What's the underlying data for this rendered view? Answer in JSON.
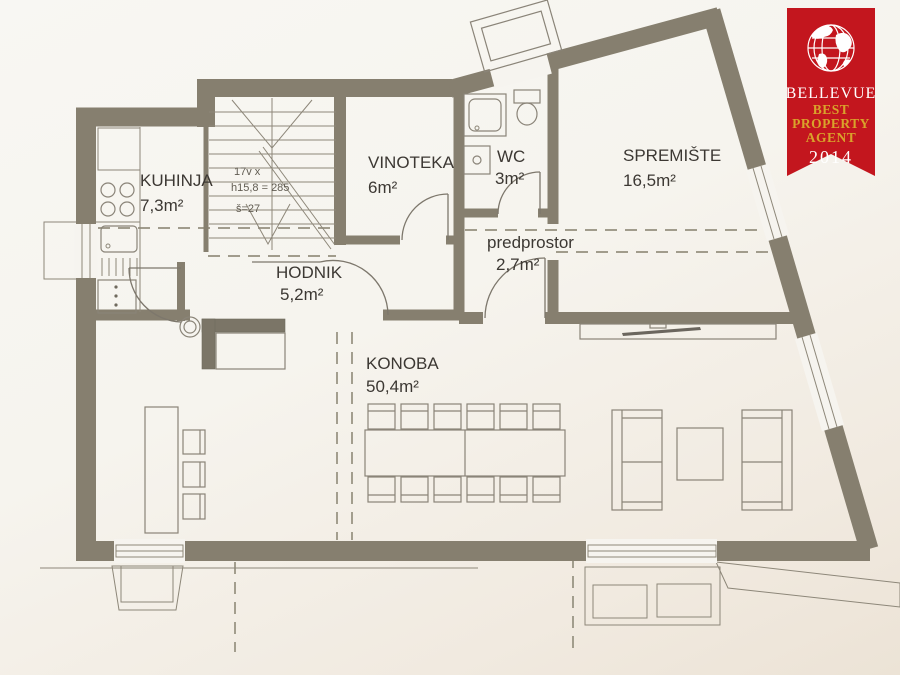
{
  "badge": {
    "brand": "BELLEVUE",
    "award_line1": "BEST",
    "award_line2": "PROPERTY",
    "award_line3": "AGENT",
    "year": "2014",
    "red": "#c3161e",
    "gold": "#d9a32b"
  },
  "rooms": {
    "kuhinja": {
      "name": "KUHINJA",
      "area": "7,3m²"
    },
    "vinoteka": {
      "name": "VINOTEKA",
      "area": "6m²"
    },
    "wc": {
      "name": "WC",
      "area": "3m²"
    },
    "spremiste": {
      "name": "SPREMIŠTE",
      "area": "16,5m²"
    },
    "hodnik": {
      "name": "HODNIK",
      "area": "5,2m²"
    },
    "predprostor": {
      "name": "predprostor",
      "area": "2,7m²"
    },
    "konoba": {
      "name": "KONOBA",
      "area": "50,4m²"
    }
  },
  "stairs_note": {
    "line1": "17v x",
    "line2": "h15,8 = 285",
    "line3": "š=27"
  },
  "colors": {
    "wall": "#867f6f",
    "paper": "#f6f4ef",
    "badge_red": "#c3161e",
    "badge_gold": "#d9a32b"
  }
}
